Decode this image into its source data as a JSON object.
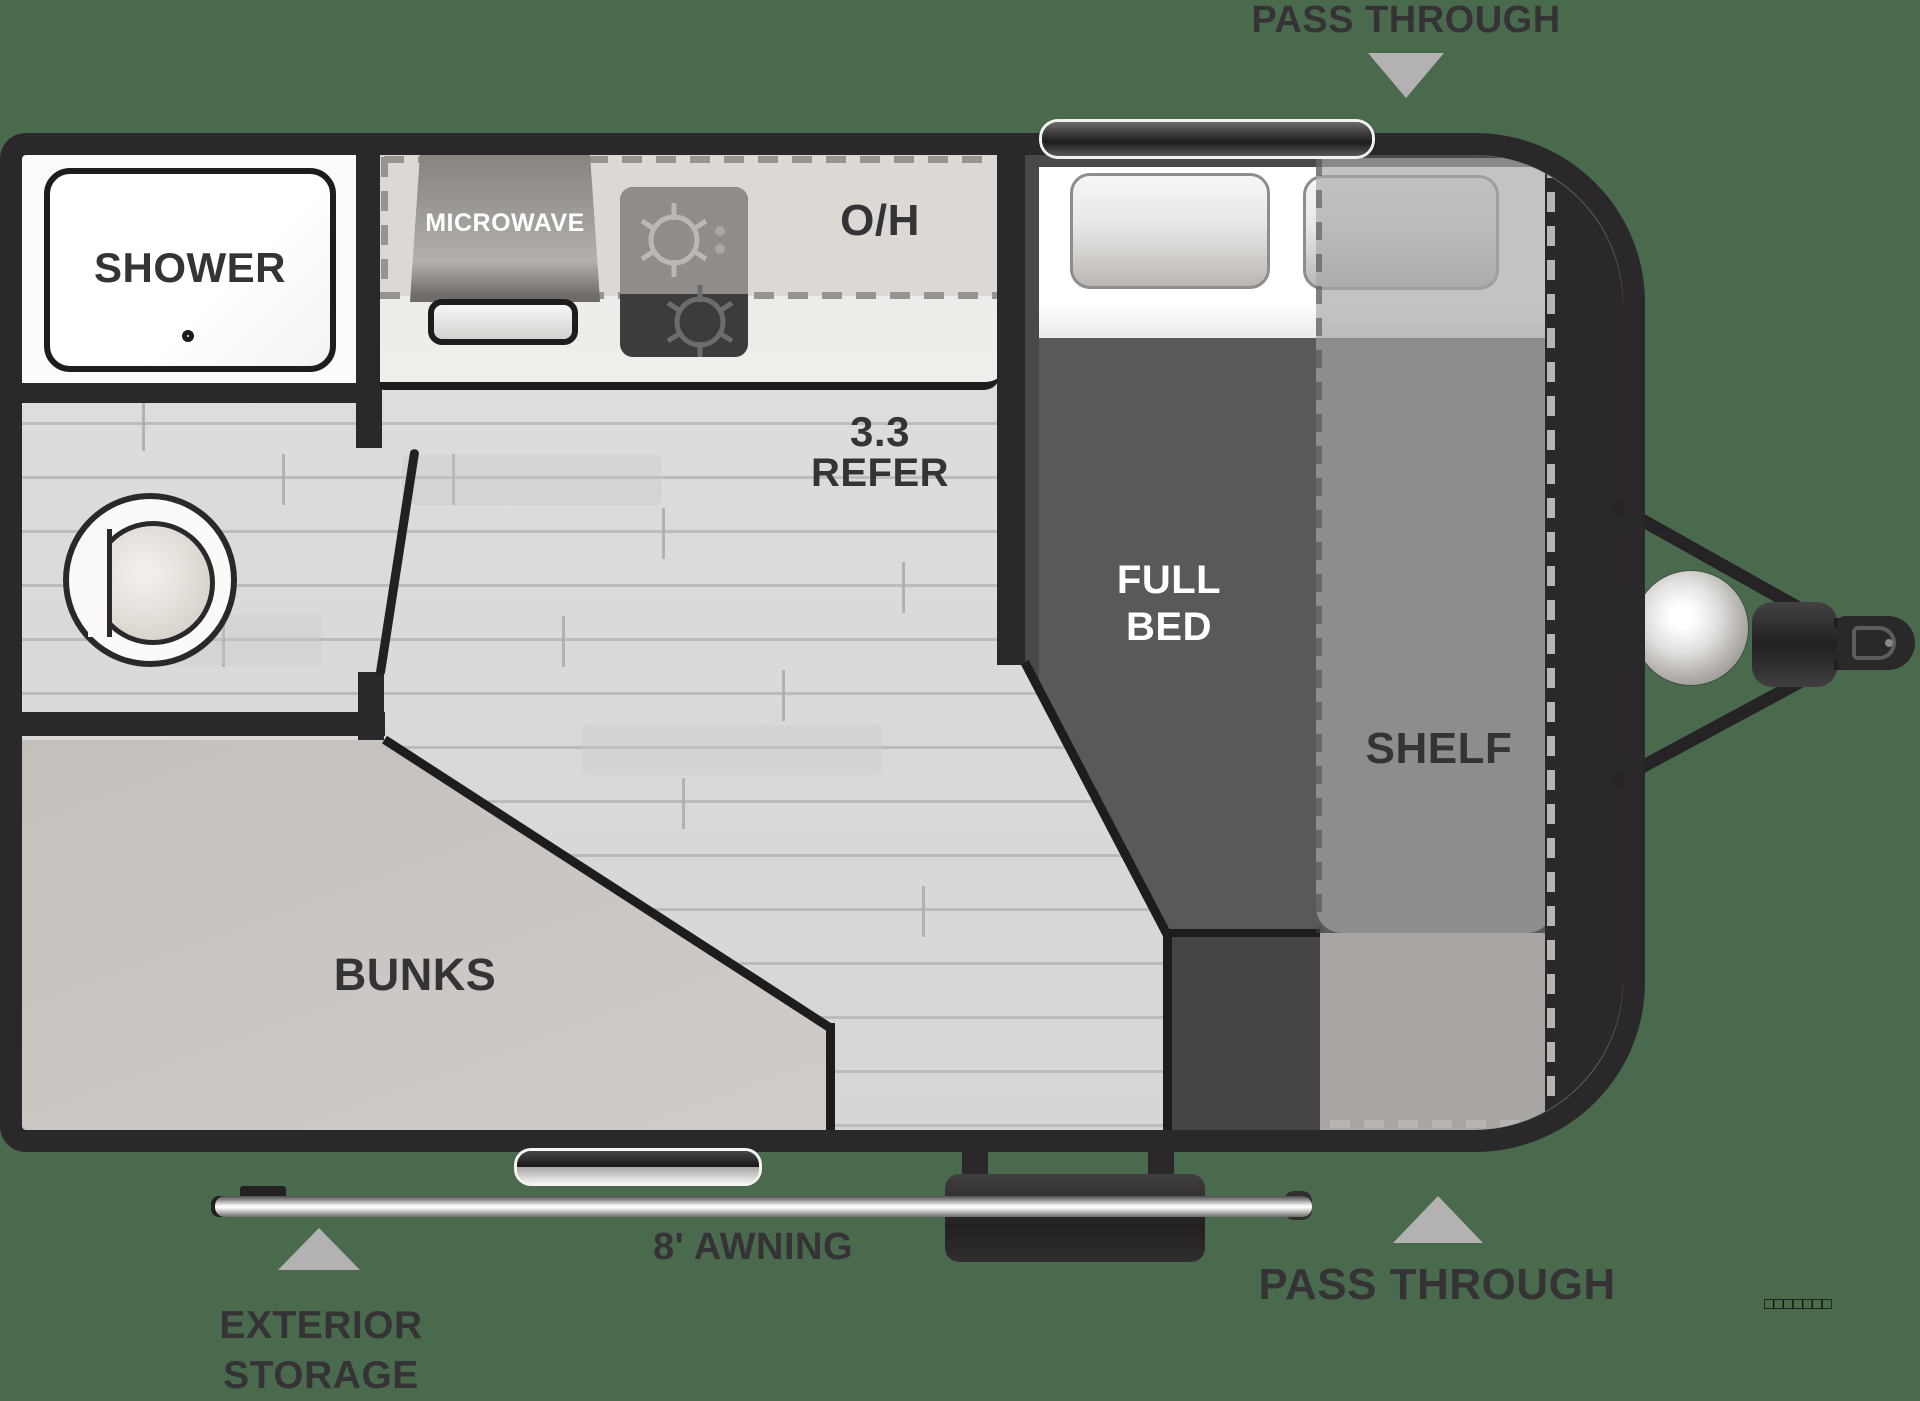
{
  "title": "travel trailer floor plan",
  "palette": {
    "background": "#4a6a4e",
    "walls": "#2b282b",
    "floor": "#dedddc",
    "arrow_gray": "#b4b1b2",
    "label_text": "#363337",
    "mattress": "#5b585a",
    "shelf_overlay": "#a8a5a6",
    "bunks": "#c4c0bc"
  },
  "labels": {
    "pass_through_top": "PASS THROUGH",
    "pass_through_bottom": "PASS THROUGH",
    "shower": "SHOWER",
    "microwave": "MICROWAVE",
    "overhead": "O/H",
    "refer1": "3.3",
    "refer2": "REFER",
    "bed1": "FULL",
    "bed2": "BED",
    "shelf": "SHELF",
    "bunks": "BUNKS",
    "awning": "8' AWNING",
    "ext1": "EXTERIOR",
    "ext2": "STORAGE",
    "watermark": "□□□□□□□"
  }
}
